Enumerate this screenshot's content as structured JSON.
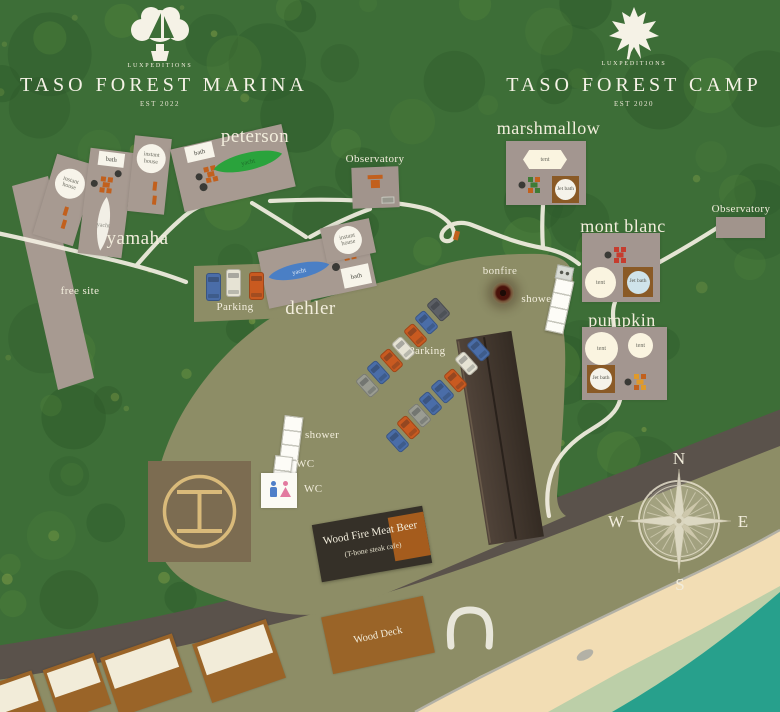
{
  "branding": {
    "marina": {
      "brand": "LUXPEDITIONS",
      "title": "TASO FOREST MARINA",
      "est": "EST 2022"
    },
    "camp": {
      "brand": "LUXPEDITIONS",
      "title": "TASO FOREST CAMP",
      "est": "EST 2020"
    }
  },
  "sites": {
    "marina": [
      "peterson",
      "yamaha",
      "dehler"
    ],
    "camp": [
      "marshmallow",
      "mont blanc",
      "pumpkin"
    ]
  },
  "labels": {
    "bath": "bath",
    "yacht": "yacht",
    "instant_house": "instant house",
    "tent": "tent",
    "jet_bath": "Jet bath",
    "observatory": "Observatory",
    "free_site": "free site",
    "parking": "Parking",
    "bonfire": "bonfire",
    "shower": "shower",
    "wc": "WC",
    "wood_deck": "Wood Deck"
  },
  "restaurant": {
    "name": "Wood Fire Meat Beer",
    "subtitle": "(T-bone steak cafe)"
  },
  "compass": {
    "n": "N",
    "e": "E",
    "s": "S",
    "w": "W"
  },
  "colors": {
    "forest": "#3d6e37",
    "ground": "#8d8d66",
    "building": "#a79a91",
    "sand": "#f2ddb4",
    "sea": "#27a08c",
    "road": "#5a524b",
    "path": "#f3efe2",
    "accent_orange": "#c2601d",
    "yacht_green": "#2aa33c",
    "yacht_blue": "#4a7fc5",
    "cabana_brown": "#9a6428",
    "text_cream": "#f3eedd"
  }
}
